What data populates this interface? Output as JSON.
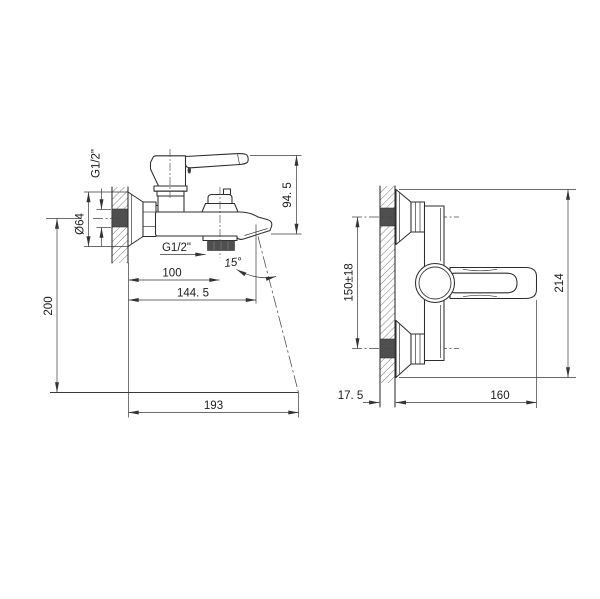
{
  "colors": {
    "background": "#ffffff",
    "line": "#2d2d2d",
    "dim": "#3a3a3a",
    "fill_dark": "#4f4f4f"
  },
  "side_view": {
    "title": "bath mixer side projection",
    "dims": {
      "top_thread": "G1/2\"",
      "flange_diameter": "Ø64",
      "handle_to_spout_height": "94. 5",
      "bottom_thread": "G1/2\"",
      "wall_to_shower_outlet": "100",
      "spout_angle": "15°",
      "wall_to_spout": "144. 5",
      "center_to_floor": "200",
      "total_projection": "193"
    }
  },
  "front_view": {
    "title": "bath mixer front projection",
    "dims": {
      "supply_center_distance": "150±18",
      "overall_height": "214",
      "wall_thickness": "17. 5",
      "body_projection": "160"
    }
  }
}
